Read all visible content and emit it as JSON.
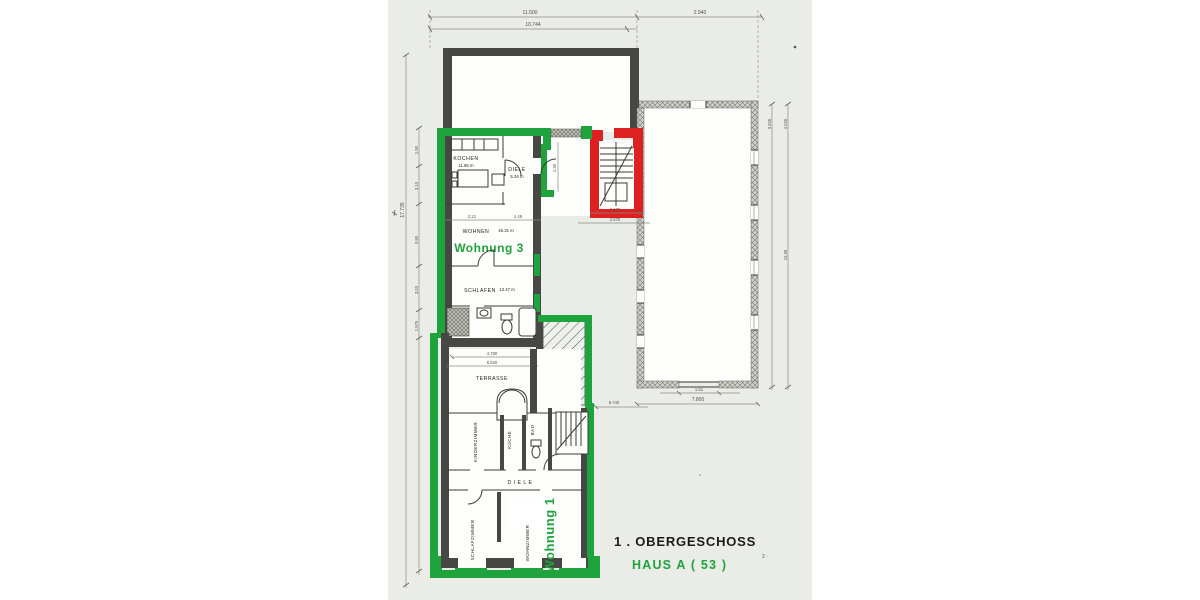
{
  "titles": {
    "floor": "1 . OBERGESCHOSS",
    "house": "HAUS  A ( 53 )",
    "page_mark": "2 ·"
  },
  "apartments": {
    "w3": "Wohnung 3",
    "w1": "Wohnung 1"
  },
  "rooms": {
    "kochen": {
      "label": "KOCHEN",
      "area": "11.86 m"
    },
    "diele3": {
      "label": "DIELE",
      "area": "5.34 m"
    },
    "wohnen": {
      "label": "WOHNEN",
      "area": "46.31 m"
    },
    "schlafen": {
      "label": "SCHLAFEN",
      "area": "13.47 m"
    },
    "terrasse": {
      "label": "TERRASSE"
    },
    "kinderzimmer": {
      "label": "KINDERZIMMER"
    },
    "kueche": {
      "label": "KÜCHE"
    },
    "bad": {
      "label": "BAD"
    },
    "diele1": {
      "label": "D I E L E"
    },
    "schlafzimmer": {
      "label": "SCHLAFZIMMER"
    },
    "wohnzimmer": {
      "label": "WOHNZIMMER"
    }
  },
  "dims": {
    "top_total": "11.500",
    "top_inner": "10.744",
    "top_right": "2.940",
    "left_total": "17.735",
    "left_chain": [
      "1.50",
      "3.13",
      "3.90",
      "3.03",
      "1.975"
    ],
    "right_chain": [
      "3.945",
      "4.045",
      "15.59"
    ],
    "w3_chain": [
      "3.21",
      "1.48"
    ],
    "corridor": "1.36",
    "stair_row1": "2.170",
    "stair_row2": "2.570",
    "terrace_a": "4.760",
    "terrace_b": "5.520",
    "mid": "5.740",
    "door_w": "1.51",
    "bottom_total": "7.800"
  },
  "colors": {
    "paper": "#eaece8",
    "wall": "#474743",
    "green": "#1fa33c",
    "red": "#dd2020",
    "dim": "#8a8a82"
  }
}
